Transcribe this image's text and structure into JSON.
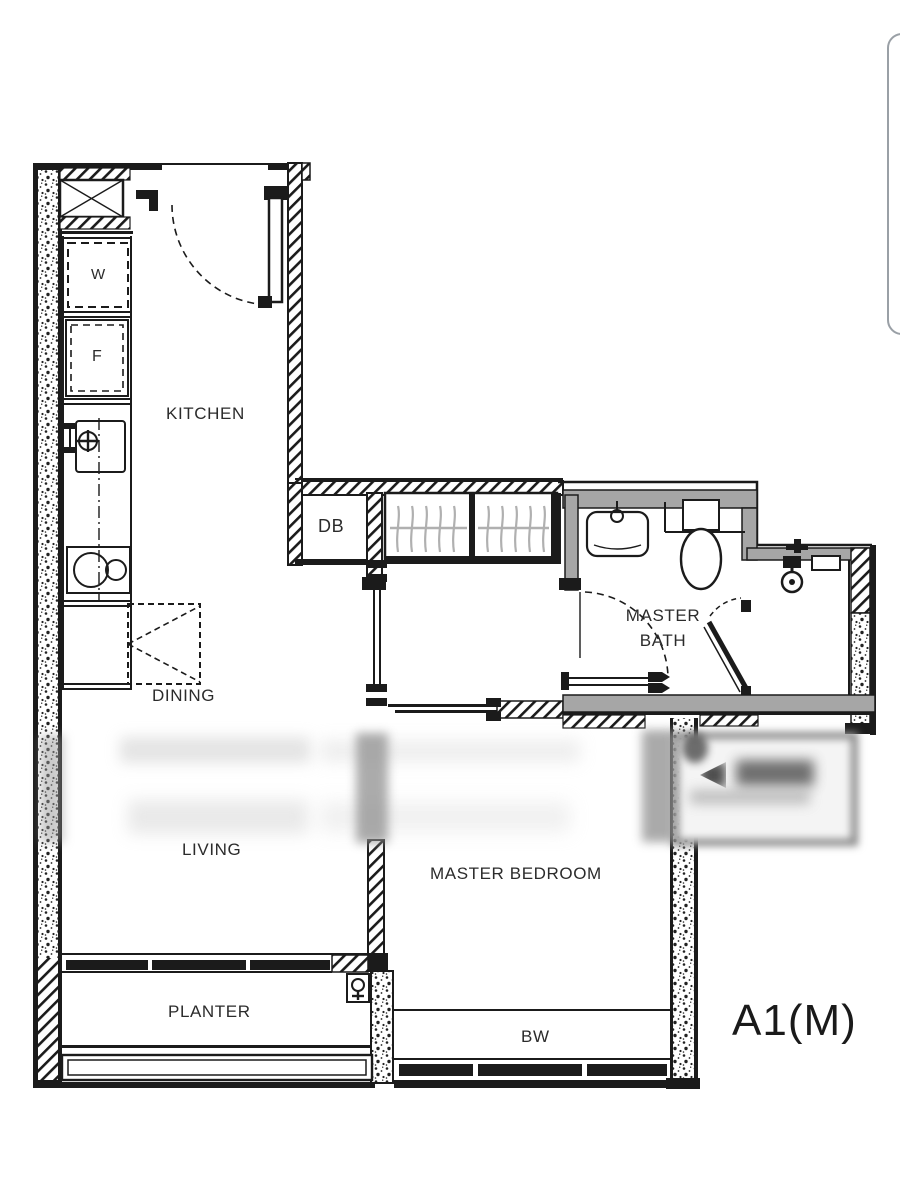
{
  "unit": {
    "label": "A1(M)"
  },
  "rooms": {
    "kitchen": "KITCHEN",
    "dining": "DINING",
    "living": "LIVING",
    "master_bedroom": "MASTER BEDROOM",
    "master_bath_line1": "MASTER",
    "master_bath_line2": "BATH",
    "planter": "PLANTER",
    "bay_window": "BW"
  },
  "fixtures": {
    "distribution_board": "DB",
    "washer": "W",
    "fridge": "F"
  },
  "colors": {
    "line": "#1b1b1b",
    "wall_gray": "#a6a6a6",
    "hanger_gray": "#b0b0b0",
    "scroll_pill_border": "#9aa0a6",
    "background": "#ffffff"
  }
}
